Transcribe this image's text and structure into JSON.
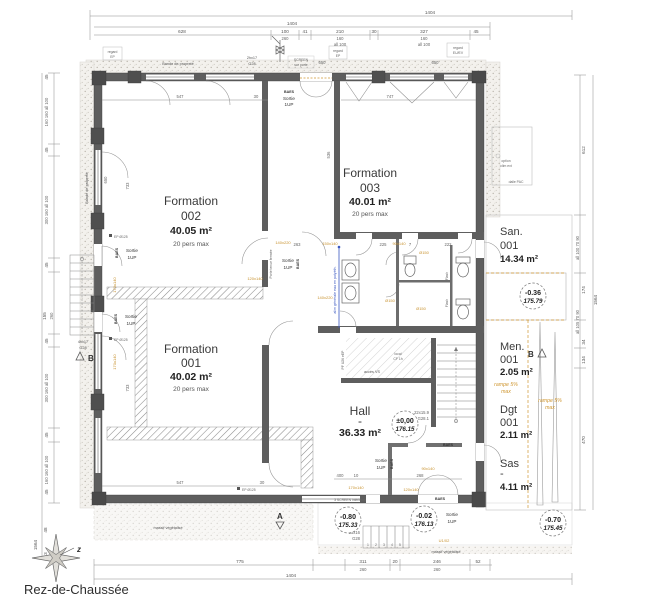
{
  "title": "Rez-de-Chaussée",
  "compass": "z",
  "colors": {
    "wall": "#5e5e5e",
    "annotation_orange": "#c8922f",
    "annotation_blue": "#3a57c0",
    "dim_gray": "#6b6b6b"
  },
  "rooms": {
    "f002": {
      "name": "Formation",
      "num": "002",
      "area": "40.05 m²",
      "cap": "20 pers max"
    },
    "f003": {
      "name": "Formation",
      "num": "003",
      "area": "40.01 m²",
      "cap": "20 pers max"
    },
    "f001": {
      "name": "Formation",
      "num": "001",
      "area": "40.02 m²",
      "cap": "20 pers max"
    },
    "hall": {
      "name": "Hall",
      "dash": "-",
      "area": "36.33 m²"
    },
    "san": {
      "name": "San.",
      "num": "001",
      "area": "14.34 m²"
    },
    "men": {
      "name": "Men.",
      "num": "001",
      "area": "2.05 m²"
    },
    "dgt": {
      "name": "Dgt",
      "num": "001",
      "area": "2.11 m²"
    },
    "sas": {
      "name": "Sas",
      "dash": "-",
      "area": "4.11 m²"
    }
  },
  "levels": {
    "hall": {
      "v": "±0,00",
      "alt": "176.15"
    },
    "san": {
      "v": "-0.36",
      "alt": "175.79"
    },
    "sw": {
      "v": "-0.80",
      "alt": "175.33"
    },
    "entry": {
      "v": "-0.02",
      "alt": "176.13"
    },
    "se": {
      "v": "-0.70",
      "alt": "175.45"
    }
  },
  "exits": {
    "baes": "BAES",
    "sortie": "Sortie",
    "up": "1UP",
    "door_note": "Porte tenue fermée"
  },
  "stairs": {
    "main": "22x15.9",
    "main2": "G28.1",
    "south": "56x16",
    "south2": "G28",
    "west": "4hx17",
    "west2": "G28",
    "entry": "2hx17",
    "entry2": "G28"
  },
  "ramp": {
    "l1": "rampe 5%",
    "l2": "max"
  },
  "annotations": {
    "bande": "Bande de propreté",
    "regard": "regard",
    "ep": "EP",
    "euev": "EU/EV",
    "screen_porte_1": "SCREEN",
    "screen_porte_2": "sur porte",
    "screen_int": "3 SCREEN intérieurs",
    "massif": "massif végétalisé",
    "option_clim_1": "option",
    "option_clim_2": "clim ext",
    "dalle_pac": "dalle PAC",
    "acces_vs": "accès VS",
    "local_cf_1": "local",
    "local_cf_2": "CF 1h",
    "pf": "PF U26 eEP",
    "alim": "alim générale eau en polyéth.",
    "flash": "Flash",
    "ep125": "EP Ø125",
    "s650": "650"
  },
  "markers": {
    "a": "A",
    "b": "B"
  },
  "openings": {
    "o1": "140x220",
    "o2": "150x140",
    "o3": "90x140",
    "o4": "Ø150",
    "o5": "120x140",
    "o6": "140x220",
    "o7": "Ø150",
    "o8": "Ø150",
    "o9": "170x140",
    "o10": "120x140",
    "o11": "90x140",
    "o12": "170x140",
    "o13": "170x140",
    "u102": "U1/02"
  },
  "dims": {
    "top": {
      "total_outer": "1404",
      "total": "1404",
      "d628": "628",
      "d100": "100",
      "d260": "260",
      "d41": "41",
      "d210": "210",
      "d160": "160",
      "all100": "all 100",
      "d30": "30",
      "d327": "327",
      "d45": "45"
    },
    "left": {
      "d45": "45",
      "g1": "160  160  all 100",
      "g2": "300  160  all 100",
      "d155": "155",
      "d260": "260",
      "d48": "48",
      "d113": "113",
      "outer": "1564"
    },
    "right": {
      "d612": "612",
      "g1": "all 100  70  90",
      "d174": "174",
      "outer": "1564",
      "g2": "all 105  70  90",
      "d34": "34",
      "d134": "134",
      "d470": "470"
    },
    "bottom": {
      "d775": "775",
      "total": "1404",
      "d311": "311",
      "d260a": "260",
      "d20": "20",
      "d246": "246",
      "d260b": "260",
      "d52": "52"
    },
    "inner": {
      "d547a": "547",
      "d30a": "30",
      "d747": "747",
      "d547b": "547",
      "d30b": "30",
      "d263": "263",
      "d225": "225",
      "d7": "7",
      "d222": "222",
      "d400": "400",
      "d10": "10",
      "d268": "268",
      "d733": "733",
      "d650": "650",
      "d536": "536"
    }
  },
  "stair_numbers": {
    "n1": "1",
    "n2": "2",
    "n3": "3",
    "n4": "4",
    "n5": "5"
  }
}
